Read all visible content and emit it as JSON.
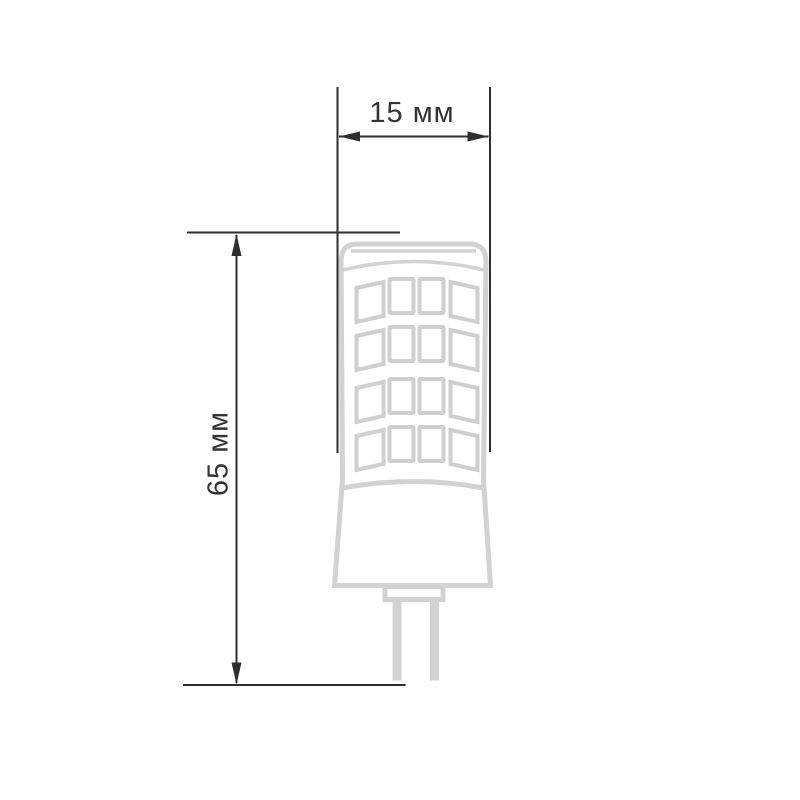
{
  "page": {
    "background": "#ffffff"
  },
  "diagram": {
    "subject": "g4-led-capsule-bulb-dimension-drawing",
    "width_label": "15 мм",
    "height_label": "65 мм",
    "colors": {
      "bulb_outline": "#d2d2d2",
      "led_chip_outline": "#cfcfcf",
      "dimension_lines": "#2e2e2e",
      "label_text": "#333333",
      "background": "#ffffff"
    }
  }
}
